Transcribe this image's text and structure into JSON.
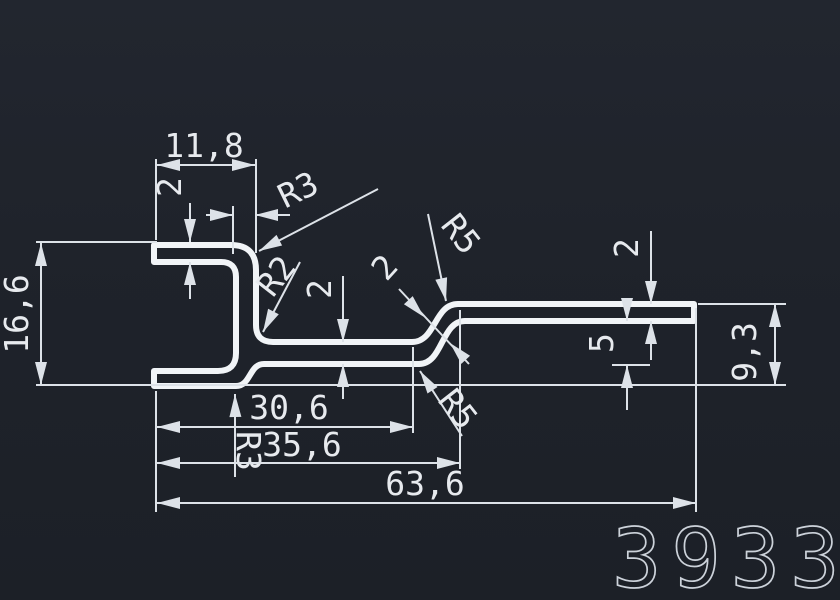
{
  "drawing": {
    "part_number": "3933",
    "labels": {
      "top_width": "11,8",
      "top_thickness": "2",
      "radius_top_outer": "R3",
      "stem_thickness": "2",
      "radius_inner": "R2",
      "web_thickness": "2",
      "height_left": "16,6",
      "radius_upper_s": "R5",
      "slant_thickness": "2",
      "right_thickness": "2",
      "step_height": "5",
      "height_right": "9,3",
      "width_inner": "30,6",
      "radius_bottom_step": "R3",
      "width_mid": "35,6",
      "width_total": "63,6",
      "radius_lower_s": "R5"
    },
    "colors": {
      "background": "#1f232b",
      "line": "#f1f4f7",
      "dimline": "#dde2e8",
      "dimtext": "#e7eaee",
      "partnum": "#ccd2da"
    }
  }
}
